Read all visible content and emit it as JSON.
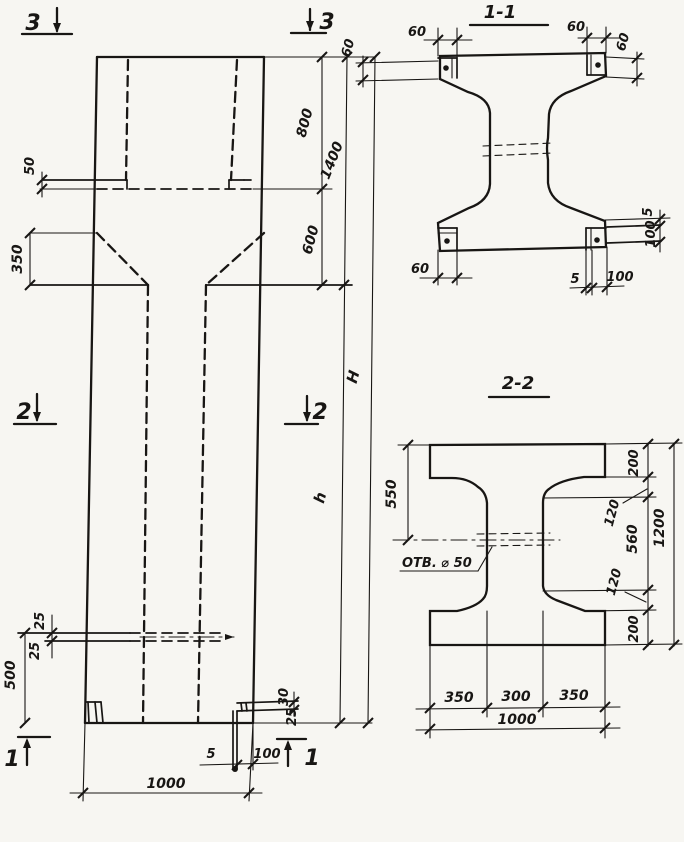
{
  "drawing": {
    "paper_color": "#f7f6f2",
    "ink_color": "#181614",
    "elevation": {
      "marks": {
        "top_left": "3",
        "top_right": "3",
        "mid_left": "2",
        "mid_right": "2",
        "bottom_left": "1",
        "bottom_right": "1"
      },
      "dims": {
        "ledge_offset": "50",
        "taper_height": "350",
        "top_block": "800",
        "upper_total": "1400",
        "transition": "600",
        "total_height": "H",
        "shaft_height": "h",
        "slot_upper": "25",
        "slot_lower": "25",
        "base_zone": "500",
        "tab_upper": "30",
        "tab_lower": "25",
        "shoe_gap": "5",
        "shoe_width": "100",
        "base_width": "1000"
      }
    },
    "section_1_1": {
      "title": "1-1",
      "dims": {
        "plate_tl_w": "60",
        "plate_tl_h": "60",
        "plate_tr_w": "60",
        "plate_tr_h": "60",
        "plate_bl_w": "60",
        "plate_br_gap": "5",
        "plate_br_w": "100",
        "strip_gap": "5",
        "strip_h": "100"
      }
    },
    "section_2_2": {
      "title": "2-2",
      "hole_label": "ОТВ. ⌀ 50",
      "dims": {
        "flange_left": "550",
        "top_flange": "200",
        "taper_top": "120",
        "web_clear": "560",
        "taper_bottom": "120",
        "bottom_flange": "200",
        "total_depth": "1200",
        "left_width": "350",
        "web_width": "300",
        "right_width": "350",
        "total_width": "1000"
      }
    }
  }
}
